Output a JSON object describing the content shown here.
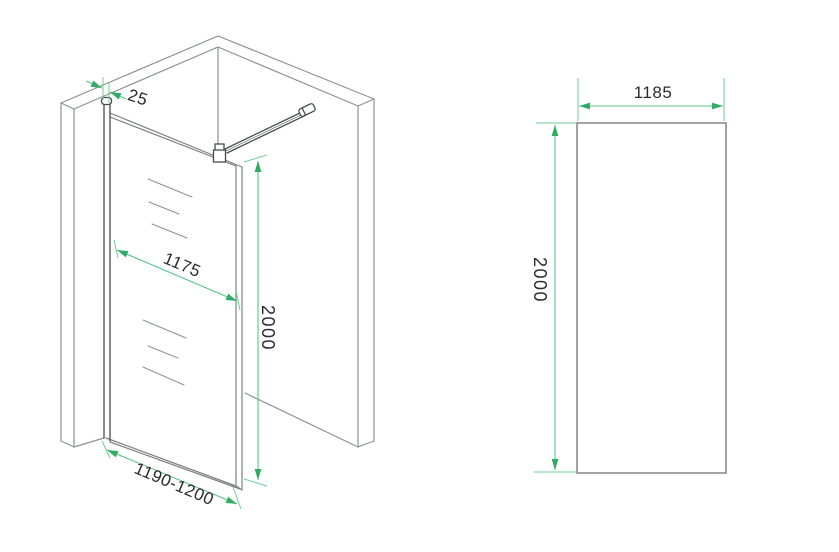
{
  "drawing": {
    "iso_view": {
      "profile_width": "25",
      "glass_width": "1175",
      "height": "2000",
      "adjustment_range": "1190-1200"
    },
    "front_view": {
      "width": "1185",
      "height": "2000"
    },
    "colors": {
      "dim_line": "#58c584",
      "dim_arrow": "#2fab63",
      "dim_text": "#2b2b2b",
      "wall_line": "#8e9391",
      "glass_line": "#7b8281",
      "hardware_line": "#474d4c",
      "panel_border": "#8c8c8c",
      "background": "#ffffff"
    }
  }
}
